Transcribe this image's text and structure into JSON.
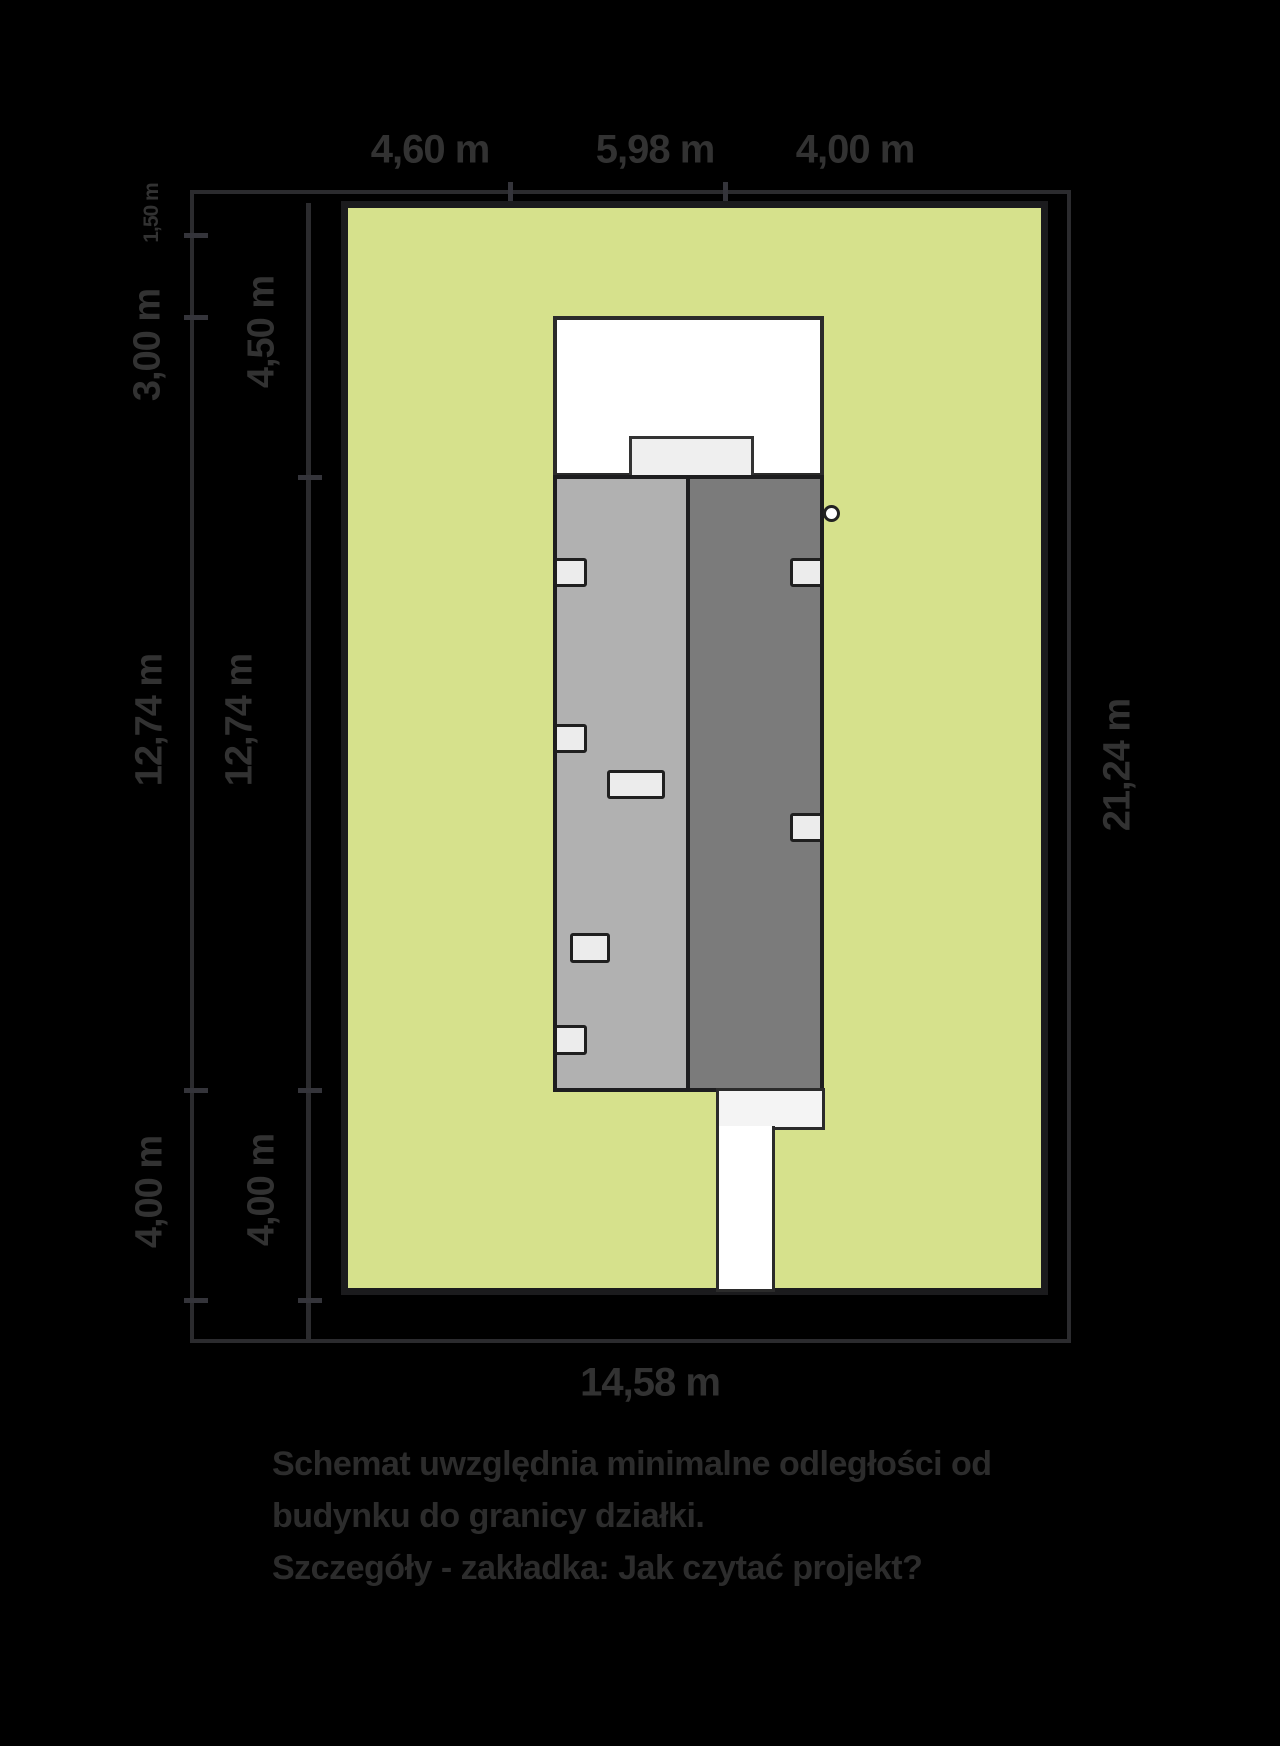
{
  "diagram": {
    "dimensions": {
      "top": [
        "4,60 m",
        "5,98 m",
        "4,00 m"
      ],
      "left_outer": [
        "1,50 m",
        "3,00 m",
        "12,74 m",
        "4,00 m"
      ],
      "left_inner": [
        "4,50 m",
        "12,74 m",
        "4,00 m"
      ],
      "right_total": "21,24 m",
      "bottom_total": "14,58 m"
    },
    "caption": {
      "line1": "Schemat uwzględnia minimalne odległości od",
      "line2": "budynku do granicy działki.",
      "line3": "Szczegóły - zakładka: Jak czytać projekt?"
    },
    "colors": {
      "background": "#000000",
      "plot_green": "#d6e18c",
      "house_light_gray": "#b1b1b1",
      "house_dark_gray": "#7b7b7b",
      "white_surface": "#ffffff",
      "dimension_ink": "#323232"
    }
  }
}
